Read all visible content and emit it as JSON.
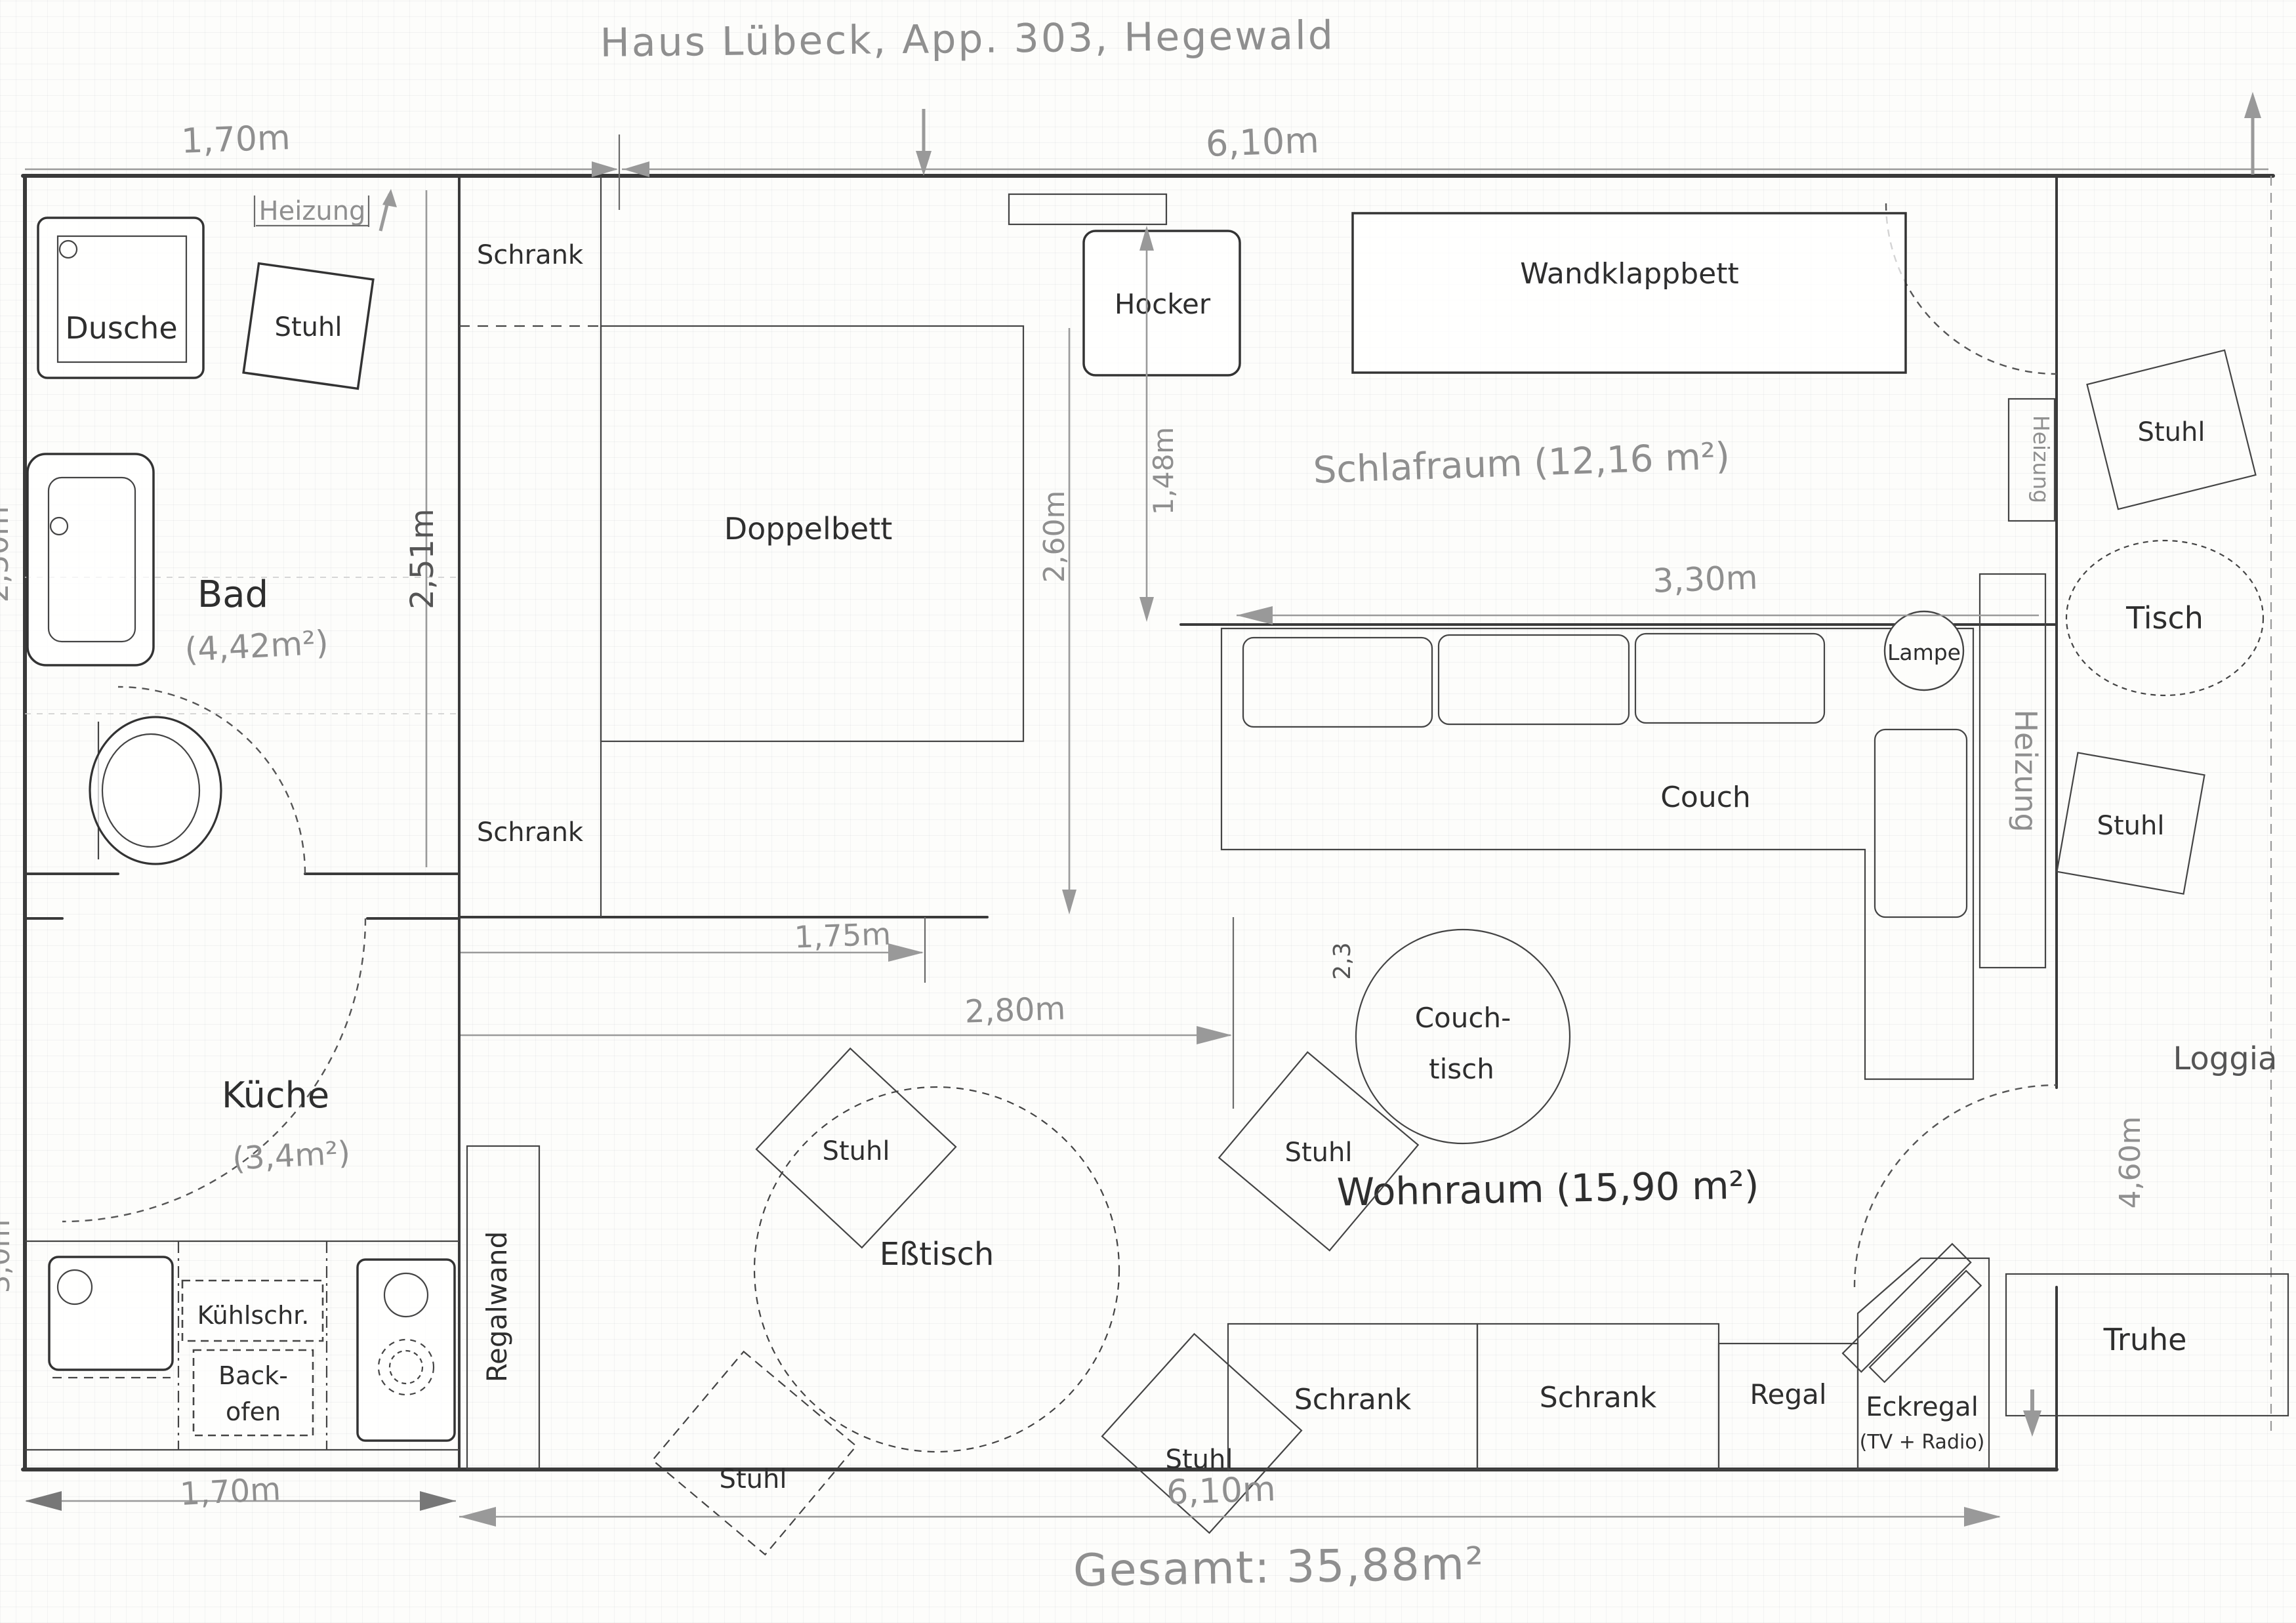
{
  "title": "Haus Lübeck, App. 303, Hegewald",
  "colors": {
    "pencil_dark": "#2e2e2e",
    "pencil_grey": "#8f8f8f",
    "wall": "#3a3a3a"
  },
  "rooms": {
    "bad": {
      "name": "Bad",
      "area": "(4,42m²)"
    },
    "kueche": {
      "name": "Küche",
      "area": "(3,4m²)"
    },
    "schlafraum": {
      "name": "Schlafraum (12,16 m²)"
    },
    "wohnraum": {
      "name": "Wohnraum (15,90 m²)"
    },
    "loggia": {
      "name": "Loggia"
    }
  },
  "furniture": {
    "dusche": "Dusche",
    "stuhl": "Stuhl",
    "heizung": "Heizung",
    "schrank": "Schrank",
    "doppelbett": "Doppelbett",
    "hocker": "Hocker",
    "wandklappbett": "Wandklappbett",
    "couch": "Couch",
    "couchtisch_1": "Couch-",
    "couchtisch_2": "tisch",
    "lampe": "Lampe",
    "tisch": "Tisch",
    "esstisch": "Eßtisch",
    "regalwand": "Regalwand",
    "kuehlschrank": "Kühlschr.",
    "backofen_1": "Back-",
    "backofen_2": "ofen",
    "regal": "Regal",
    "eckregal": "Eckregal",
    "eckregal_sub": "(TV + Radio)",
    "truhe": "Truhe"
  },
  "dimensions": {
    "top_left": "1,70m",
    "top_right": "6,10m",
    "bottom_left": "1,70m",
    "bottom_right": "6,10m",
    "total": "Gesamt: 35,88m²",
    "schrank_column": "2,51m",
    "bett_depth": "2,60m",
    "hocker_gap": "1,48m",
    "schlafraum_width": "3,30m",
    "dining_1": "1,75m",
    "dining_2": "2,80m",
    "loggia_height": "4,60m",
    "couch_note": "2,3",
    "left_edge_upper": "2,50m",
    "left_edge_lower": "3,0m"
  }
}
